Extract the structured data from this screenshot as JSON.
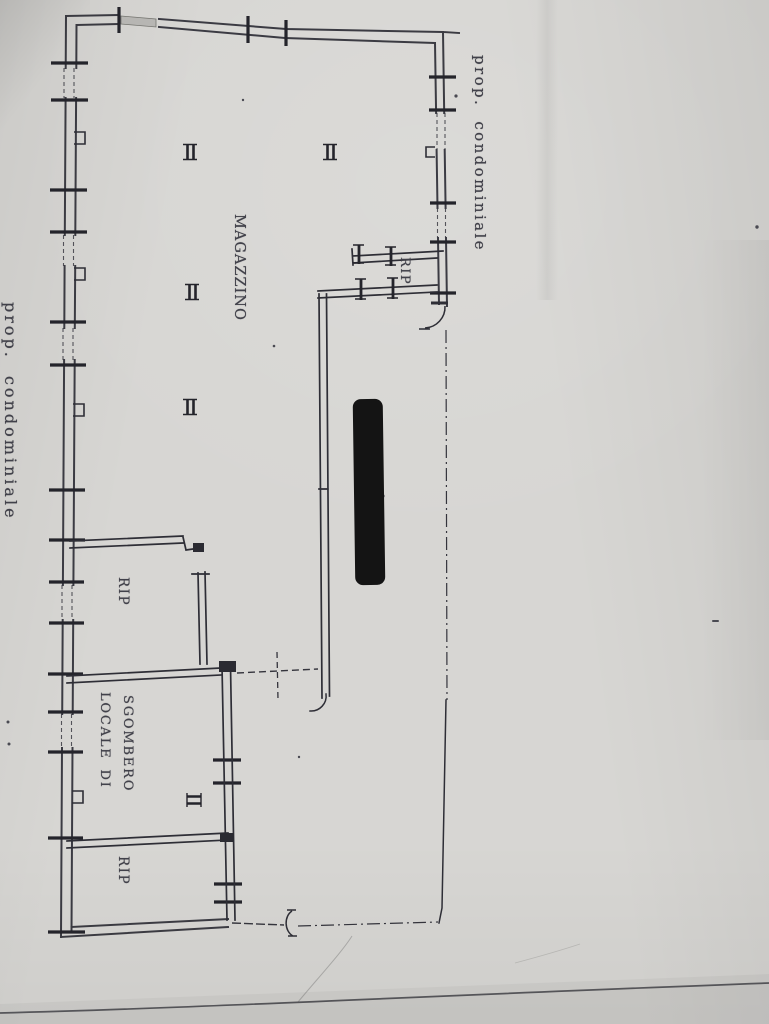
{
  "labels": {
    "prop_condominiale_right": "prop. condominiale",
    "prop_condominiale_left": "prop. condominiale",
    "magazzino": "MAGAZZINO",
    "rip_top": "RIP",
    "rip_middle": "RIP",
    "rip_bottom": "RIP",
    "locale_di": "LOCALE DI",
    "sgombero": "SGOMBERO"
  },
  "rooms": [
    {
      "name": "MAGAZZINO"
    },
    {
      "name": "RIP"
    },
    {
      "name": "RIP"
    },
    {
      "name": "LOCALE DI SGOMBERO"
    },
    {
      "name": "RIP"
    }
  ],
  "colors": {
    "paper": "#d7d6d3",
    "ink": "#2e2e36",
    "tick_ink": "#24242b",
    "label_text": "#41414a",
    "redaction": "#141414",
    "window_fill": "#b7b6b3"
  }
}
